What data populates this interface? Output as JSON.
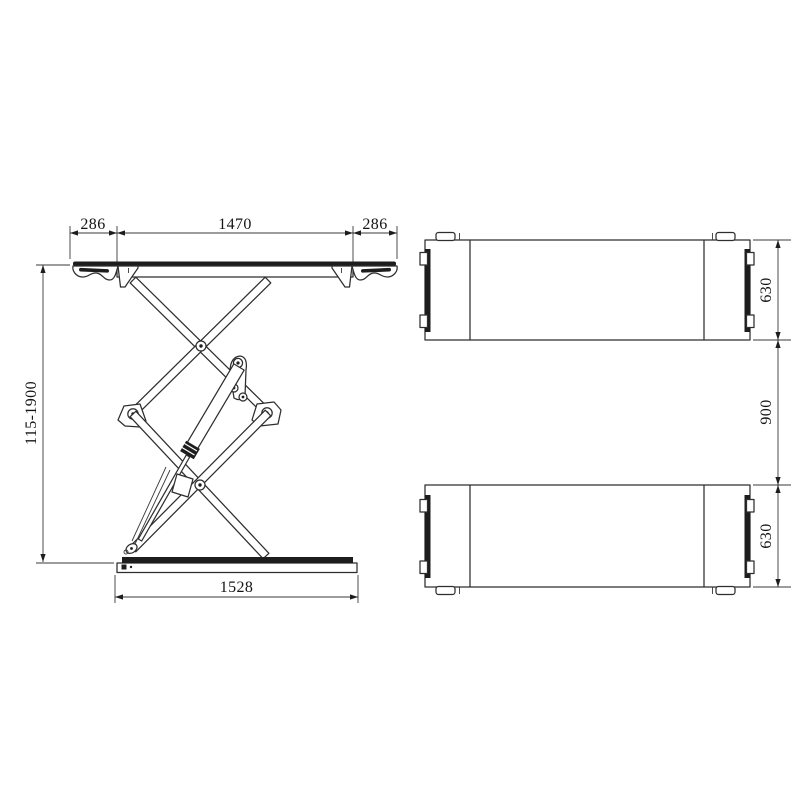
{
  "drawing": {
    "type": "technical-drawing",
    "subject": "double-scissor-lift",
    "colors": {
      "background": "#ffffff",
      "line": "#2e2e2e",
      "dark_fill": "#1d1d1d",
      "text": "#141414"
    },
    "front_view": {
      "dims": {
        "top_left_overhang": "286",
        "top_platform_length": "1470",
        "top_right_overhang": "286",
        "lift_height_range": "115-1900",
        "base_length": "1528"
      }
    },
    "plan_view": {
      "dims": {
        "platform_width_top": "630",
        "track_gap": "900",
        "platform_width_bottom": "630"
      }
    }
  }
}
